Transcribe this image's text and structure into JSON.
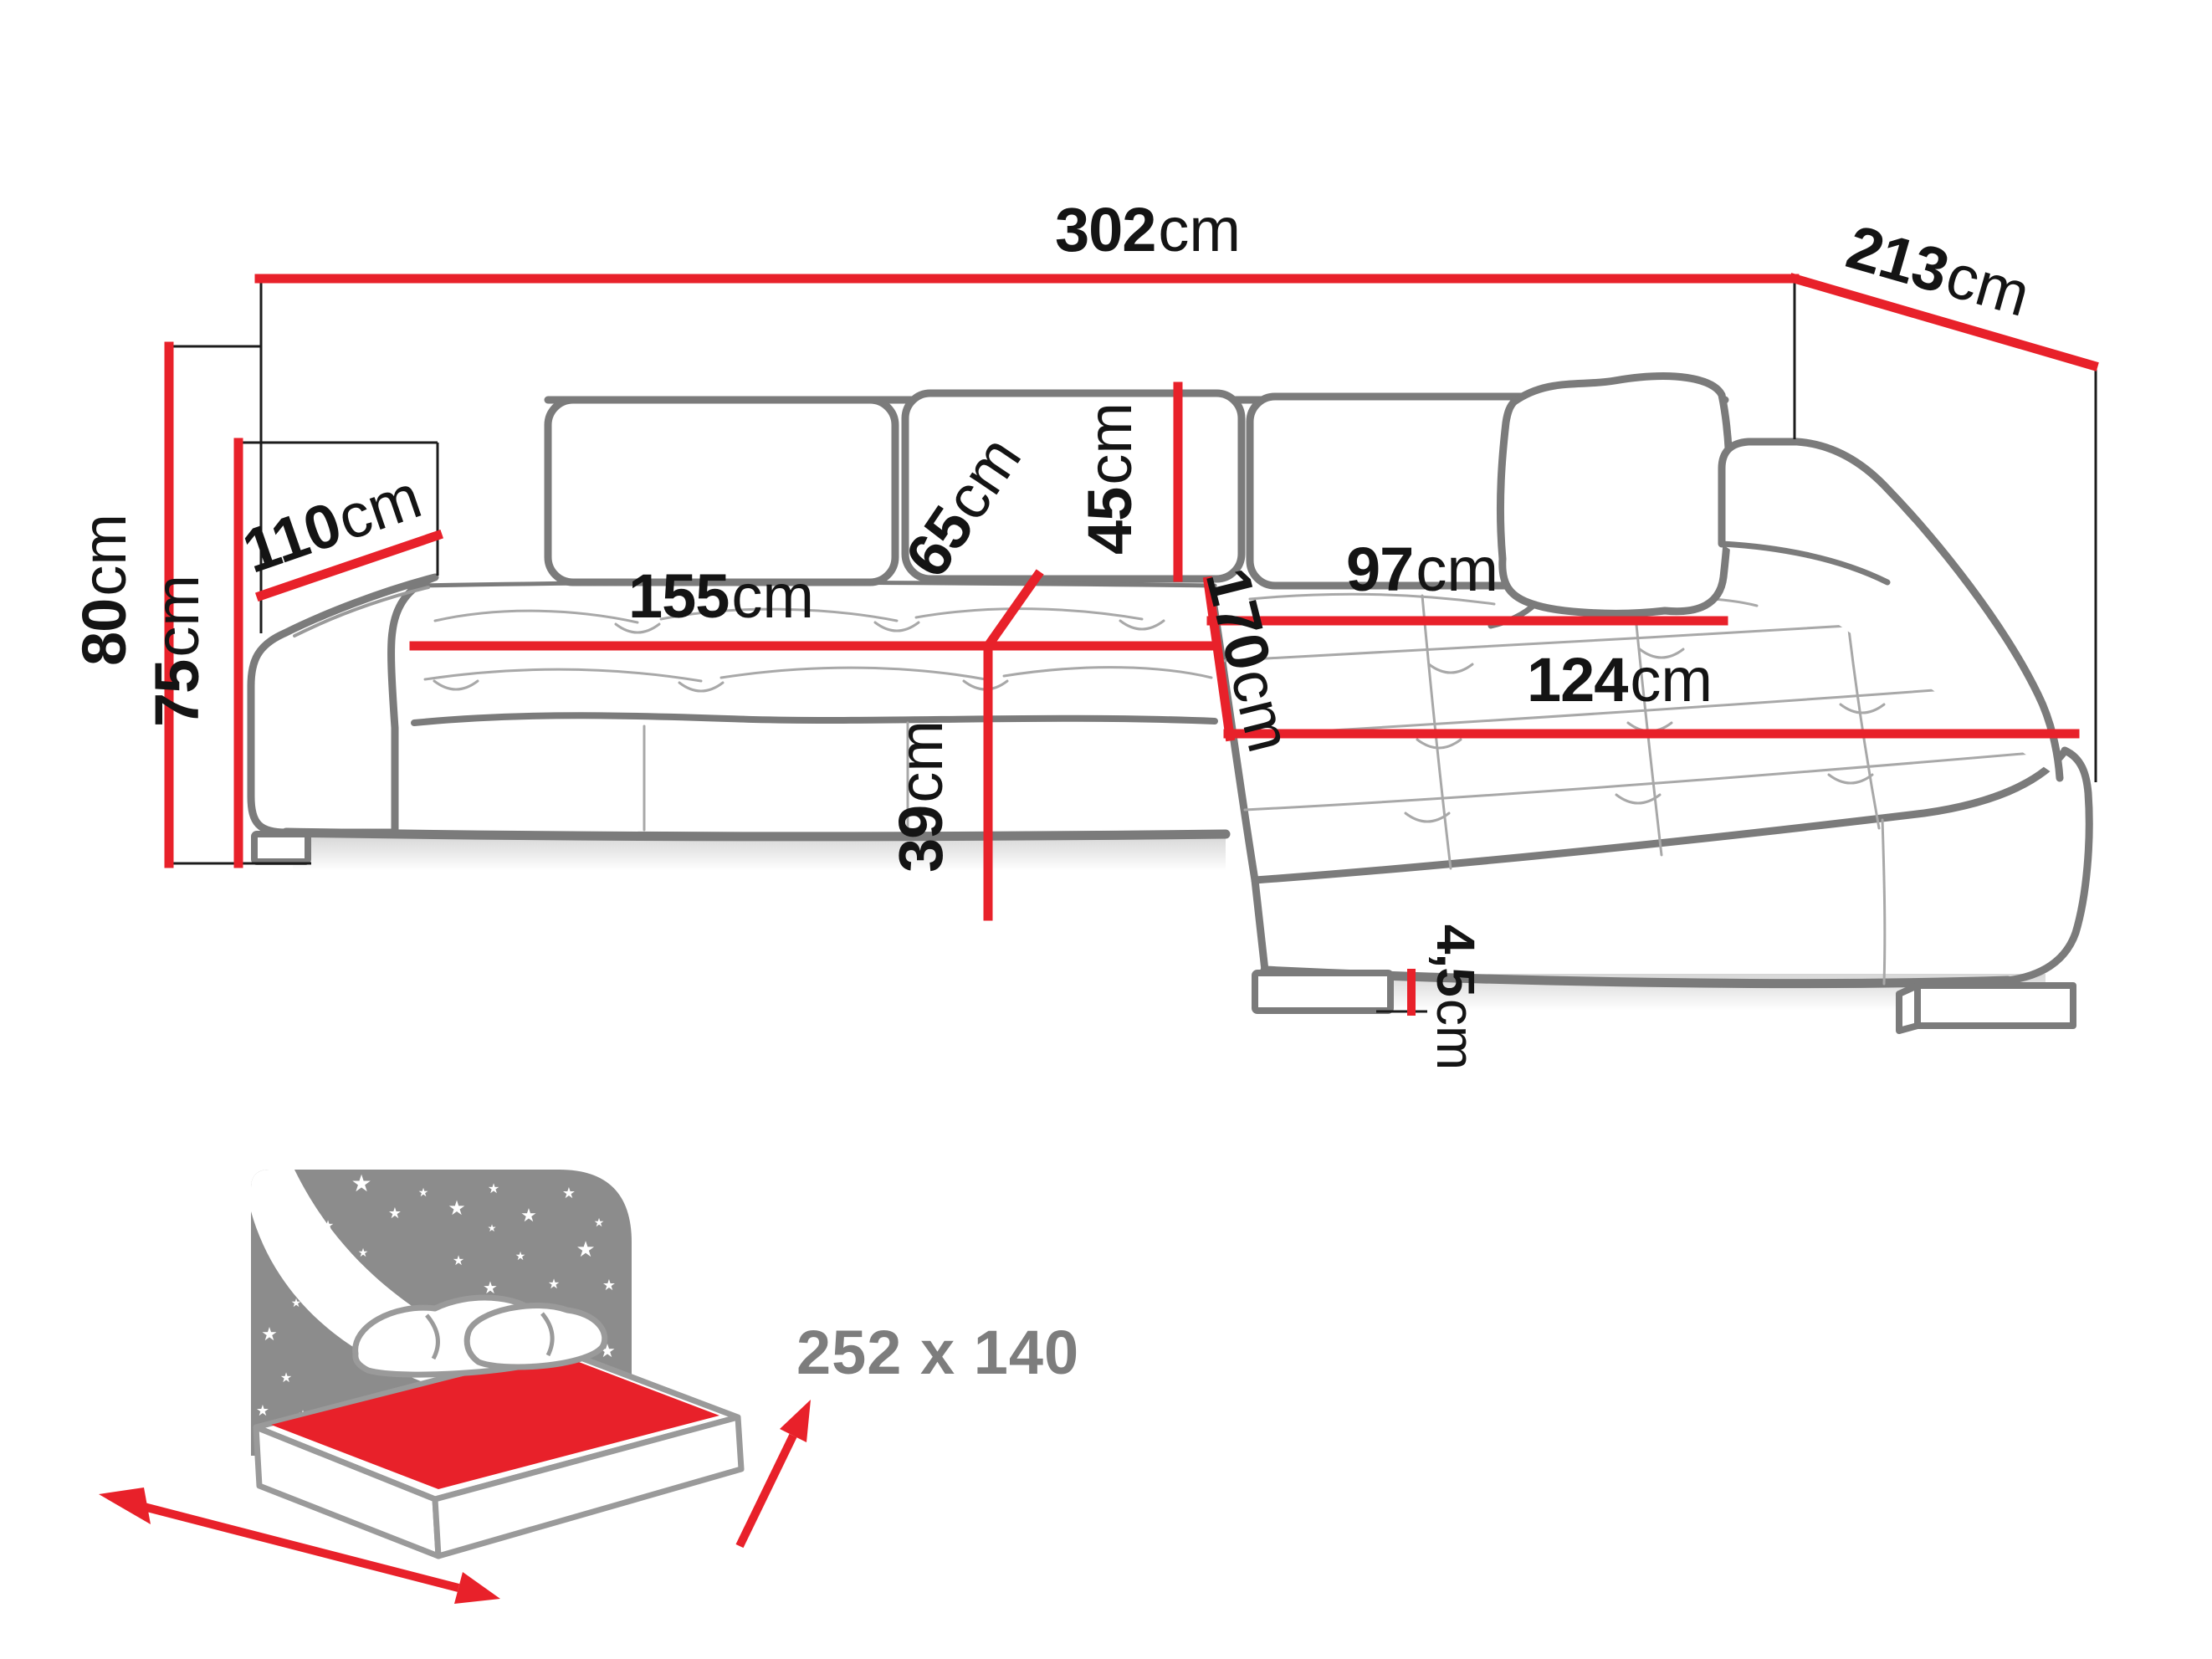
{
  "diagram": {
    "type": "furniture-dimension-diagram",
    "subject": "corner sofa with sleeping function",
    "unit": "cm",
    "dimensions": {
      "width_total": {
        "value": "302",
        "unit": "cm"
      },
      "depth_right": {
        "value": "213",
        "unit": "cm"
      },
      "height_total": {
        "value": "80",
        "unit": "cm"
      },
      "armrest_height": {
        "value": "75",
        "unit": "cm"
      },
      "armrest_depth": {
        "value": "110",
        "unit": "cm"
      },
      "seat_width": {
        "value": "155",
        "unit": "cm"
      },
      "seat_depth": {
        "value": "65",
        "unit": "cm"
      },
      "backrest_height": {
        "value": "45",
        "unit": "cm"
      },
      "chaise_length": {
        "value": "170",
        "unit": "cm"
      },
      "chaise_back_width": {
        "value": "97",
        "unit": "cm"
      },
      "chaise_front_width": {
        "value": "124",
        "unit": "cm"
      },
      "seat_height": {
        "value": "39",
        "unit": "cm"
      },
      "leg_height": {
        "value": "4,5",
        "unit": "cm"
      }
    },
    "sleeping_function": {
      "bed_size_label": "252 x 140"
    },
    "colors": {
      "dimension_line": "#e8212a",
      "sofa_outline": "#7b7b7b",
      "tuft_line": "#a8a8a8",
      "label_text": "#141414",
      "icon_gray": "#8c8c8c",
      "sleeping_label_gray": "#7d7d7d",
      "background": "#ffffff"
    },
    "icons": {
      "star_glyph": "★"
    }
  }
}
